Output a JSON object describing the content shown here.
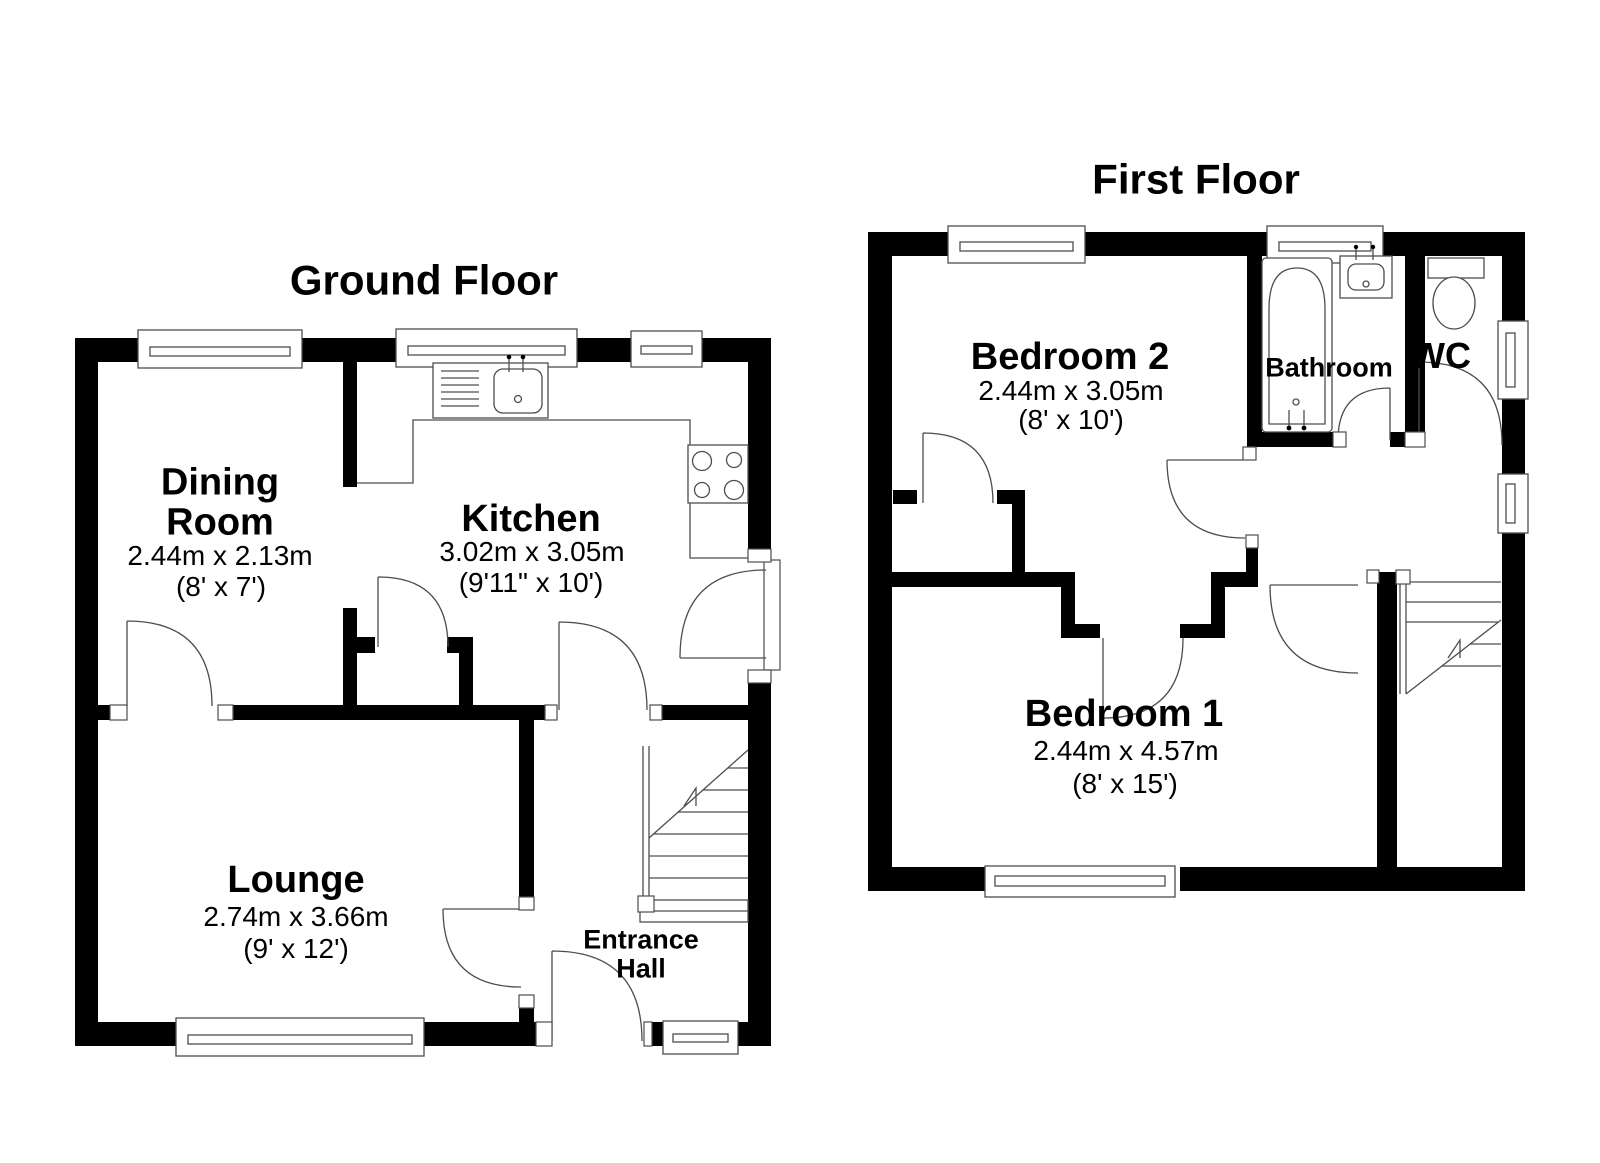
{
  "ground_floor": {
    "title": "Ground Floor",
    "rooms": {
      "dining": {
        "line1": "Dining",
        "line2": "Room",
        "metric": "2.44m x 2.13m",
        "imperial": "(8' x 7')"
      },
      "kitchen": {
        "name": "Kitchen",
        "metric": "3.02m x 3.05m",
        "imperial": "(9'11\" x 10')"
      },
      "lounge": {
        "name": "Lounge",
        "metric": "2.74m x 3.66m",
        "imperial": "(9' x 12')"
      },
      "entrance_hall": {
        "line1": "Entrance",
        "line2": "Hall"
      }
    }
  },
  "first_floor": {
    "title": "First Floor",
    "rooms": {
      "bedroom2": {
        "name": "Bedroom 2",
        "metric": "2.44m x 3.05m",
        "imperial": "(8' x 10')"
      },
      "bathroom": {
        "name": "Bathroom"
      },
      "wc": {
        "name": "WC"
      },
      "bedroom1": {
        "name": "Bedroom 1",
        "metric": "2.44m x 4.57m",
        "imperial": "(8' x 15')"
      }
    }
  },
  "colors": {
    "wall": "#000000",
    "background": "#ffffff",
    "line": "#4d4d4d",
    "text": "#000000"
  }
}
